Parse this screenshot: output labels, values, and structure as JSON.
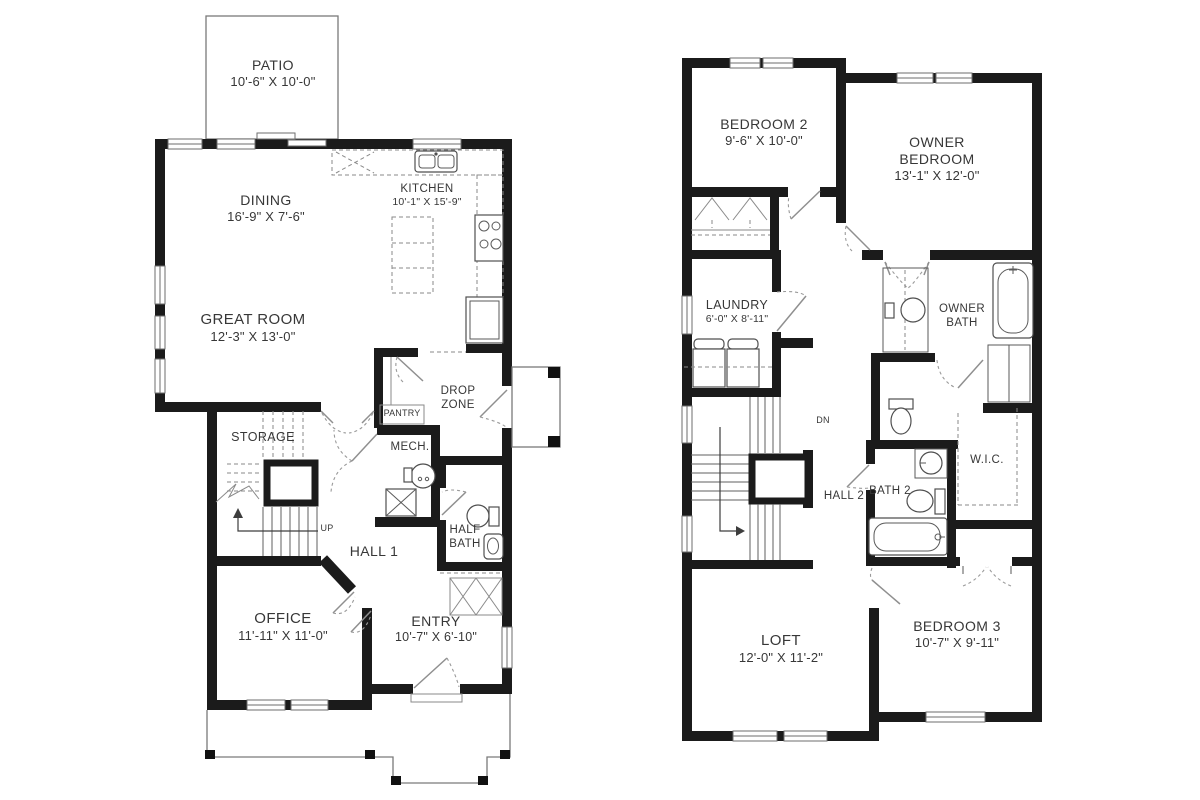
{
  "drawing": {
    "type": "residential two-story floor plan",
    "wall_color": "#1b1b1b",
    "line_color": "#7a7a7a",
    "background": "#ffffff"
  },
  "floor1": {
    "patio": {
      "name": "PATIO",
      "dims": "10'-6\" X 10'-0\""
    },
    "dining": {
      "name": "DINING",
      "dims": "16'-9\" X 7'-6\""
    },
    "kitchen": {
      "name": "KITCHEN",
      "dims": "10'-1\" X 15'-9\""
    },
    "great_room": {
      "name": "GREAT ROOM",
      "dims": "12'-3\" X 13'-0\""
    },
    "storage": {
      "name": "STORAGE"
    },
    "pantry": {
      "name": "PANTRY"
    },
    "drop_zone": {
      "name": "DROP ZONE"
    },
    "mech": {
      "name": "MECH."
    },
    "hall1": {
      "name": "HALL 1"
    },
    "half_bath": {
      "name": "HALF BATH"
    },
    "office": {
      "name": "OFFICE",
      "dims": "11'-11\" X 11'-0\""
    },
    "entry": {
      "name": "ENTRY",
      "dims": "10'-7\" X 6'-10\""
    },
    "stair_up": "UP"
  },
  "floor2": {
    "bedroom2": {
      "name": "BEDROOM 2",
      "dims": "9'-6\" X 10'-0\""
    },
    "owner_bedroom": {
      "name": "OWNER BEDROOM",
      "dims": "13'-1\" X 12'-0\""
    },
    "laundry": {
      "name": "LAUNDRY",
      "dims": "6'-0\" X 8'-11\""
    },
    "owner_bath": {
      "name": "OWNER BATH"
    },
    "hall2": {
      "name": "HALL 2"
    },
    "bath2": {
      "name": "BATH 2"
    },
    "wic": {
      "name": "W.I.C."
    },
    "loft": {
      "name": "LOFT",
      "dims": "12'-0\" X 11'-2\""
    },
    "bedroom3": {
      "name": "BEDROOM 3",
      "dims": "10'-7\" X 9'-11\""
    },
    "stair_down": "DN"
  }
}
